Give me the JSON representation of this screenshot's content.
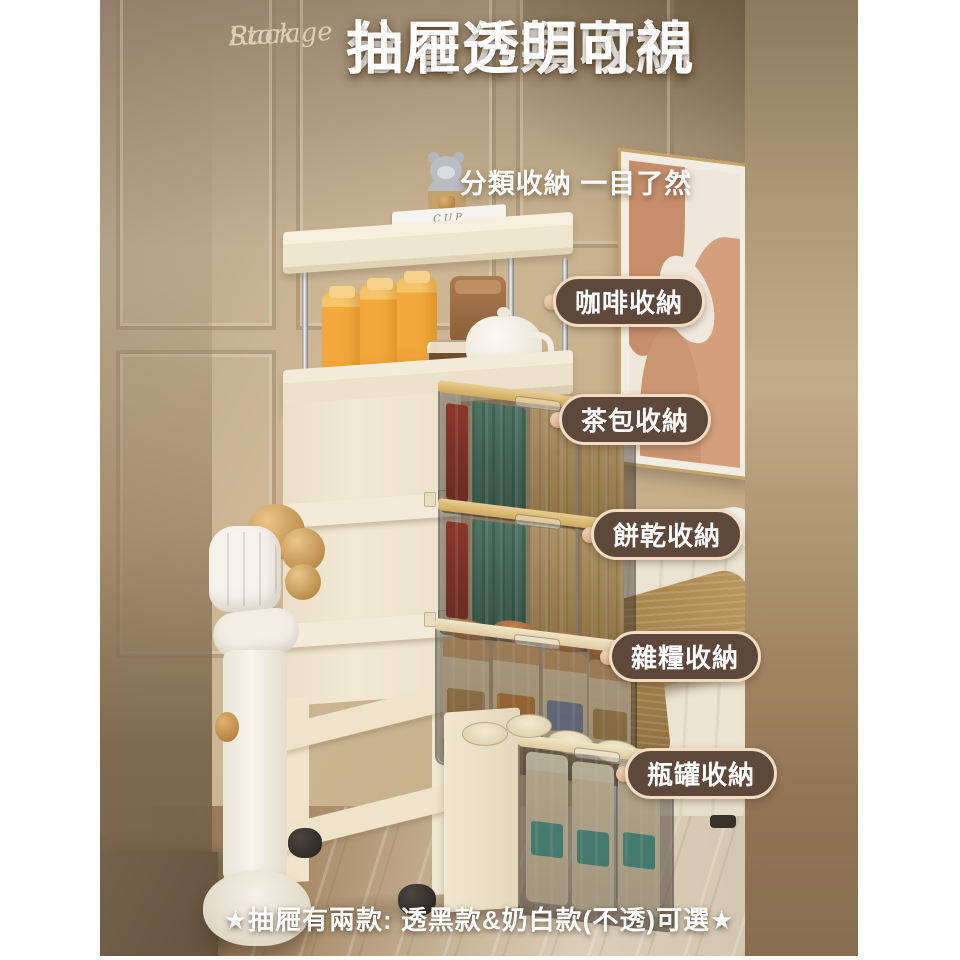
{
  "watermark": {
    "line1": "Storage",
    "line2": "Rack"
  },
  "headline": {
    "line1": "分層分類收納",
    "line2": "抽屜透明可視"
  },
  "subtitle": "分類收納 一目了然",
  "labels": [
    {
      "id": "coffee",
      "text": "咖啡收納"
    },
    {
      "id": "tea",
      "text": "茶包收納"
    },
    {
      "id": "cookie",
      "text": "餅乾收納"
    },
    {
      "id": "grain",
      "text": "雜糧收納"
    },
    {
      "id": "bottle",
      "text": "瓶罐收納"
    }
  ],
  "footer": {
    "note": "★抽屜有兩款: 透黑款&奶白款(不透)可選★"
  },
  "decor": {
    "book_top": "CUP",
    "book_bottom": "BRINGING THE HOUSE HOME"
  },
  "colors": {
    "label_bg": "#5d483b",
    "label_border": "#f3dcc2",
    "label_text": "#ffffff",
    "headline_text": "#ffffff",
    "watermark_text": "#dccfb8",
    "wall": "#cdb795",
    "rack_cream": "#f1e9d5",
    "accent_gold": "#c9973f"
  }
}
